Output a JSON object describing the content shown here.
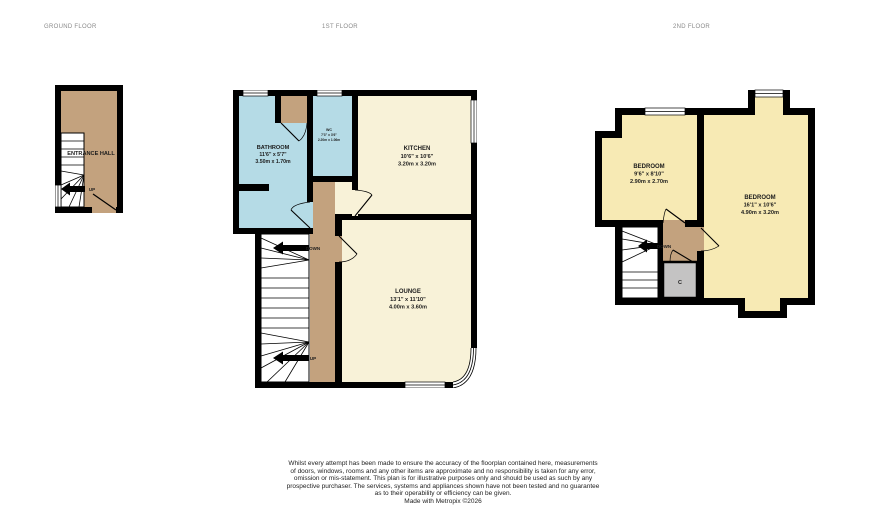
{
  "floors": {
    "ground": {
      "label": "GROUND FLOOR"
    },
    "first": {
      "label": "1ST FLOOR"
    },
    "second": {
      "label": "2ND FLOOR"
    }
  },
  "rooms": {
    "entrance_hall": {
      "name": "ENTRANCE HALL"
    },
    "bathroom": {
      "name": "BATHROOM",
      "imperial": "11'6\" x 5'7\"",
      "metric": "3.50m x 1.70m"
    },
    "wc": {
      "name": "WC",
      "imperial": "7'3\" x 3'6\"",
      "metric": "2.20m x 1.06m"
    },
    "kitchen": {
      "name": "KITCHEN",
      "imperial": "10'6\" x 10'6\"",
      "metric": "3.20m x 3.20m"
    },
    "lounge": {
      "name": "LOUNGE",
      "imperial": "13'1\" x 11'10\"",
      "metric": "4.00m x 3.60m"
    },
    "bedroom_small": {
      "name": "BEDROOM",
      "imperial": "9'6\" x 8'10\"",
      "metric": "2.90m x 2.70m"
    },
    "bedroom_large": {
      "name": "BEDROOM",
      "imperial": "16'1\" x 10'6\"",
      "metric": "4.90m x 3.20m"
    },
    "cupboard": {
      "label": "C"
    }
  },
  "stairs": {
    "up_label": "UP",
    "down_label": "DOWN"
  },
  "colors": {
    "wall": "#000000",
    "hall_tan": "#c3a27e",
    "room_cream": "#f8f2d8",
    "room_yellow": "#f7eab4",
    "room_blue": "#b5dbe6",
    "cupboard_gray": "#c4c3c3",
    "label_gray": "#8a8a8a"
  },
  "footer": {
    "disclaimer_lines": [
      "Whilst every attempt has been made to ensure the accuracy of the floorplan contained here, measurements",
      "of doors, windows, rooms and any other items are approximate and no responsibility is taken for any error,",
      "omission or mis-statement. This plan is for illustrative purposes only and should be used as such by any",
      "prospective purchaser. The services, systems and appliances shown have not been tested and no guarantee",
      "as to their operability or efficiency can be given."
    ],
    "credit": "Made with Metropix ©2026"
  }
}
